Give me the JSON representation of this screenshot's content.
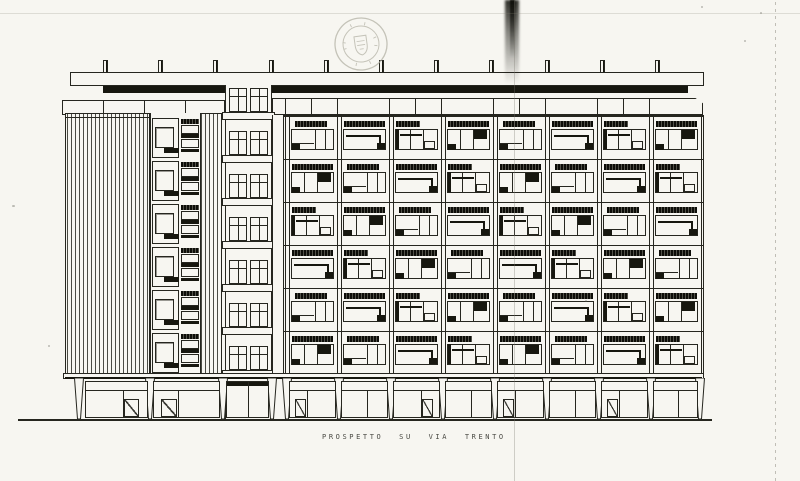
{
  "sheet": {
    "type": "scanned architectural elevation drawing",
    "caption": "PROSPETTO SU VIA TRENTO",
    "stamp": "circular-municipal-seal",
    "colors": {
      "paper": "#f7f6f1",
      "ink": "#26261f",
      "dark": "#17170f",
      "stamp_faint": "#b4b2a6",
      "fold": "#8d8b80"
    },
    "building": {
      "roof_posts": 11,
      "left_tower_style": "vertical-louvers",
      "balcony_column_floors": 6,
      "service_shaft_rows": 3,
      "stair_tower_levels": 7,
      "facade_bays": 8,
      "facade_floors": 6,
      "storefront_variants": [
        "door-right",
        "door-left",
        "twin",
        "door-left",
        "plain",
        "door-right",
        "plain",
        "door-left",
        "plain",
        "door-left",
        "plain"
      ]
    }
  }
}
